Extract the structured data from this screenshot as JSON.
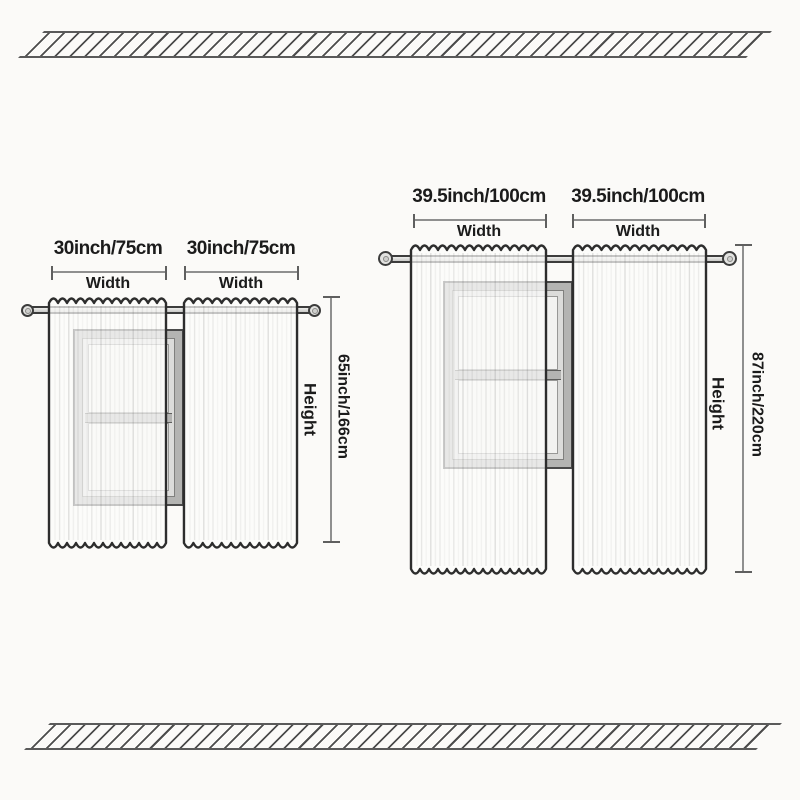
{
  "diagram": {
    "background": "#fbfaf8",
    "sets": {
      "small": {
        "panel1_width_label": "30inch/75cm",
        "panel2_width_label": "30inch/75cm",
        "width_caption": "Width",
        "height_label": "65inch/166cm",
        "height_caption": "Height"
      },
      "large": {
        "panel1_width_label": "39.5inch/100cm",
        "panel2_width_label": "39.5inch/100cm",
        "width_caption": "Width",
        "height_label": "87inch/220cm",
        "height_caption": "Height"
      }
    },
    "colors": {
      "text": "#1b1b1b",
      "dim_line": "#8f8f8f",
      "dim_tick": "#5f5f5f",
      "hatch_line": "#4c4c4c",
      "panel_outline": "#2d2d2d",
      "window_frame": "#b4b4b2",
      "rod_outline": "#3c3c3c"
    }
  }
}
